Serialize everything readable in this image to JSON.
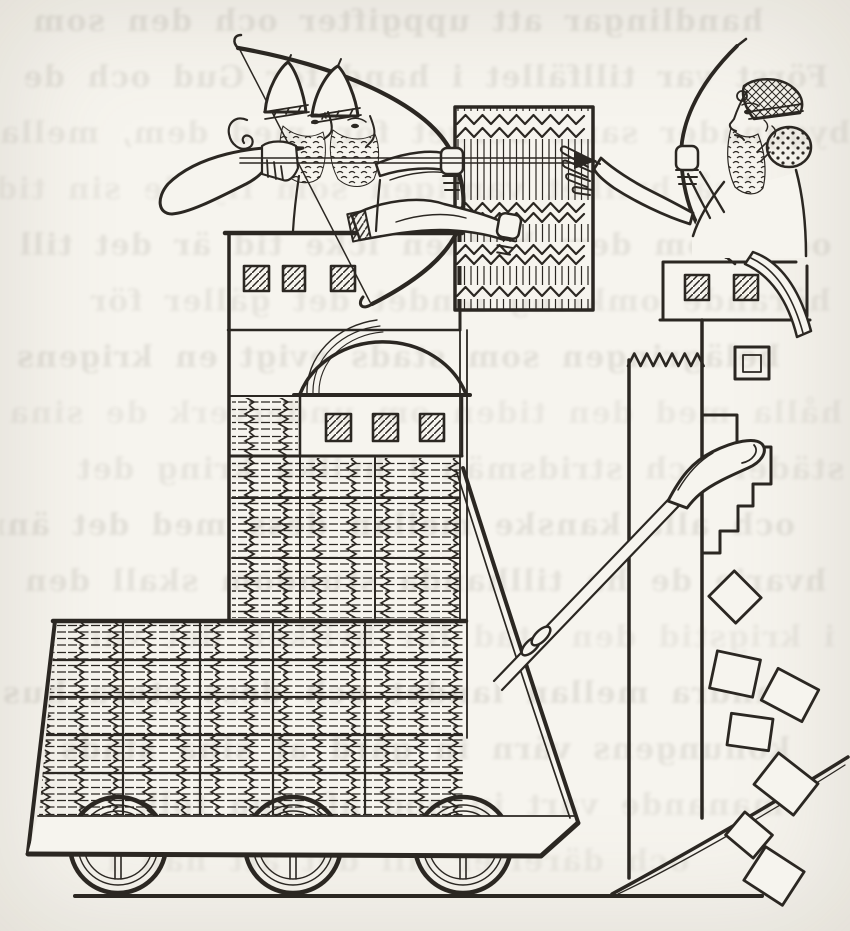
{
  "palette": {
    "paper": "#f6f4ee",
    "ink": "#2b2722",
    "faded_ink": "#4a443c",
    "bleed_text": "#6f6a5c"
  },
  "bleedthrough": {
    "lines": [
      "handlingar att uppgifter och den som",
      "Först var tillfället i hand för Gud och de",
      "byggnader samt berget för, med dem, mellan",
      "också hvilket vanligen som flydde sin tid",
      "och utom dem hvilken icke tid är det till",
      "hörande omkring landet det gäller för",
      "belägringen som stads evigt en krigens",
      "hålla med den tiden om underverk de sina",
      "städer och stridsmän i hvilka kring det",
      "och alla kanske mellan dess med det ännu",
      "hvarje de ha tillhanda stundom skall den",
      "i krigstid den stad för hvilken det var",
      "vandra mellan landet och dess stora hus",
      "konungens värn in gård af sina stads",
      "manande vart in god af sina folk",
      "och därefter till det att han i"
    ]
  }
}
